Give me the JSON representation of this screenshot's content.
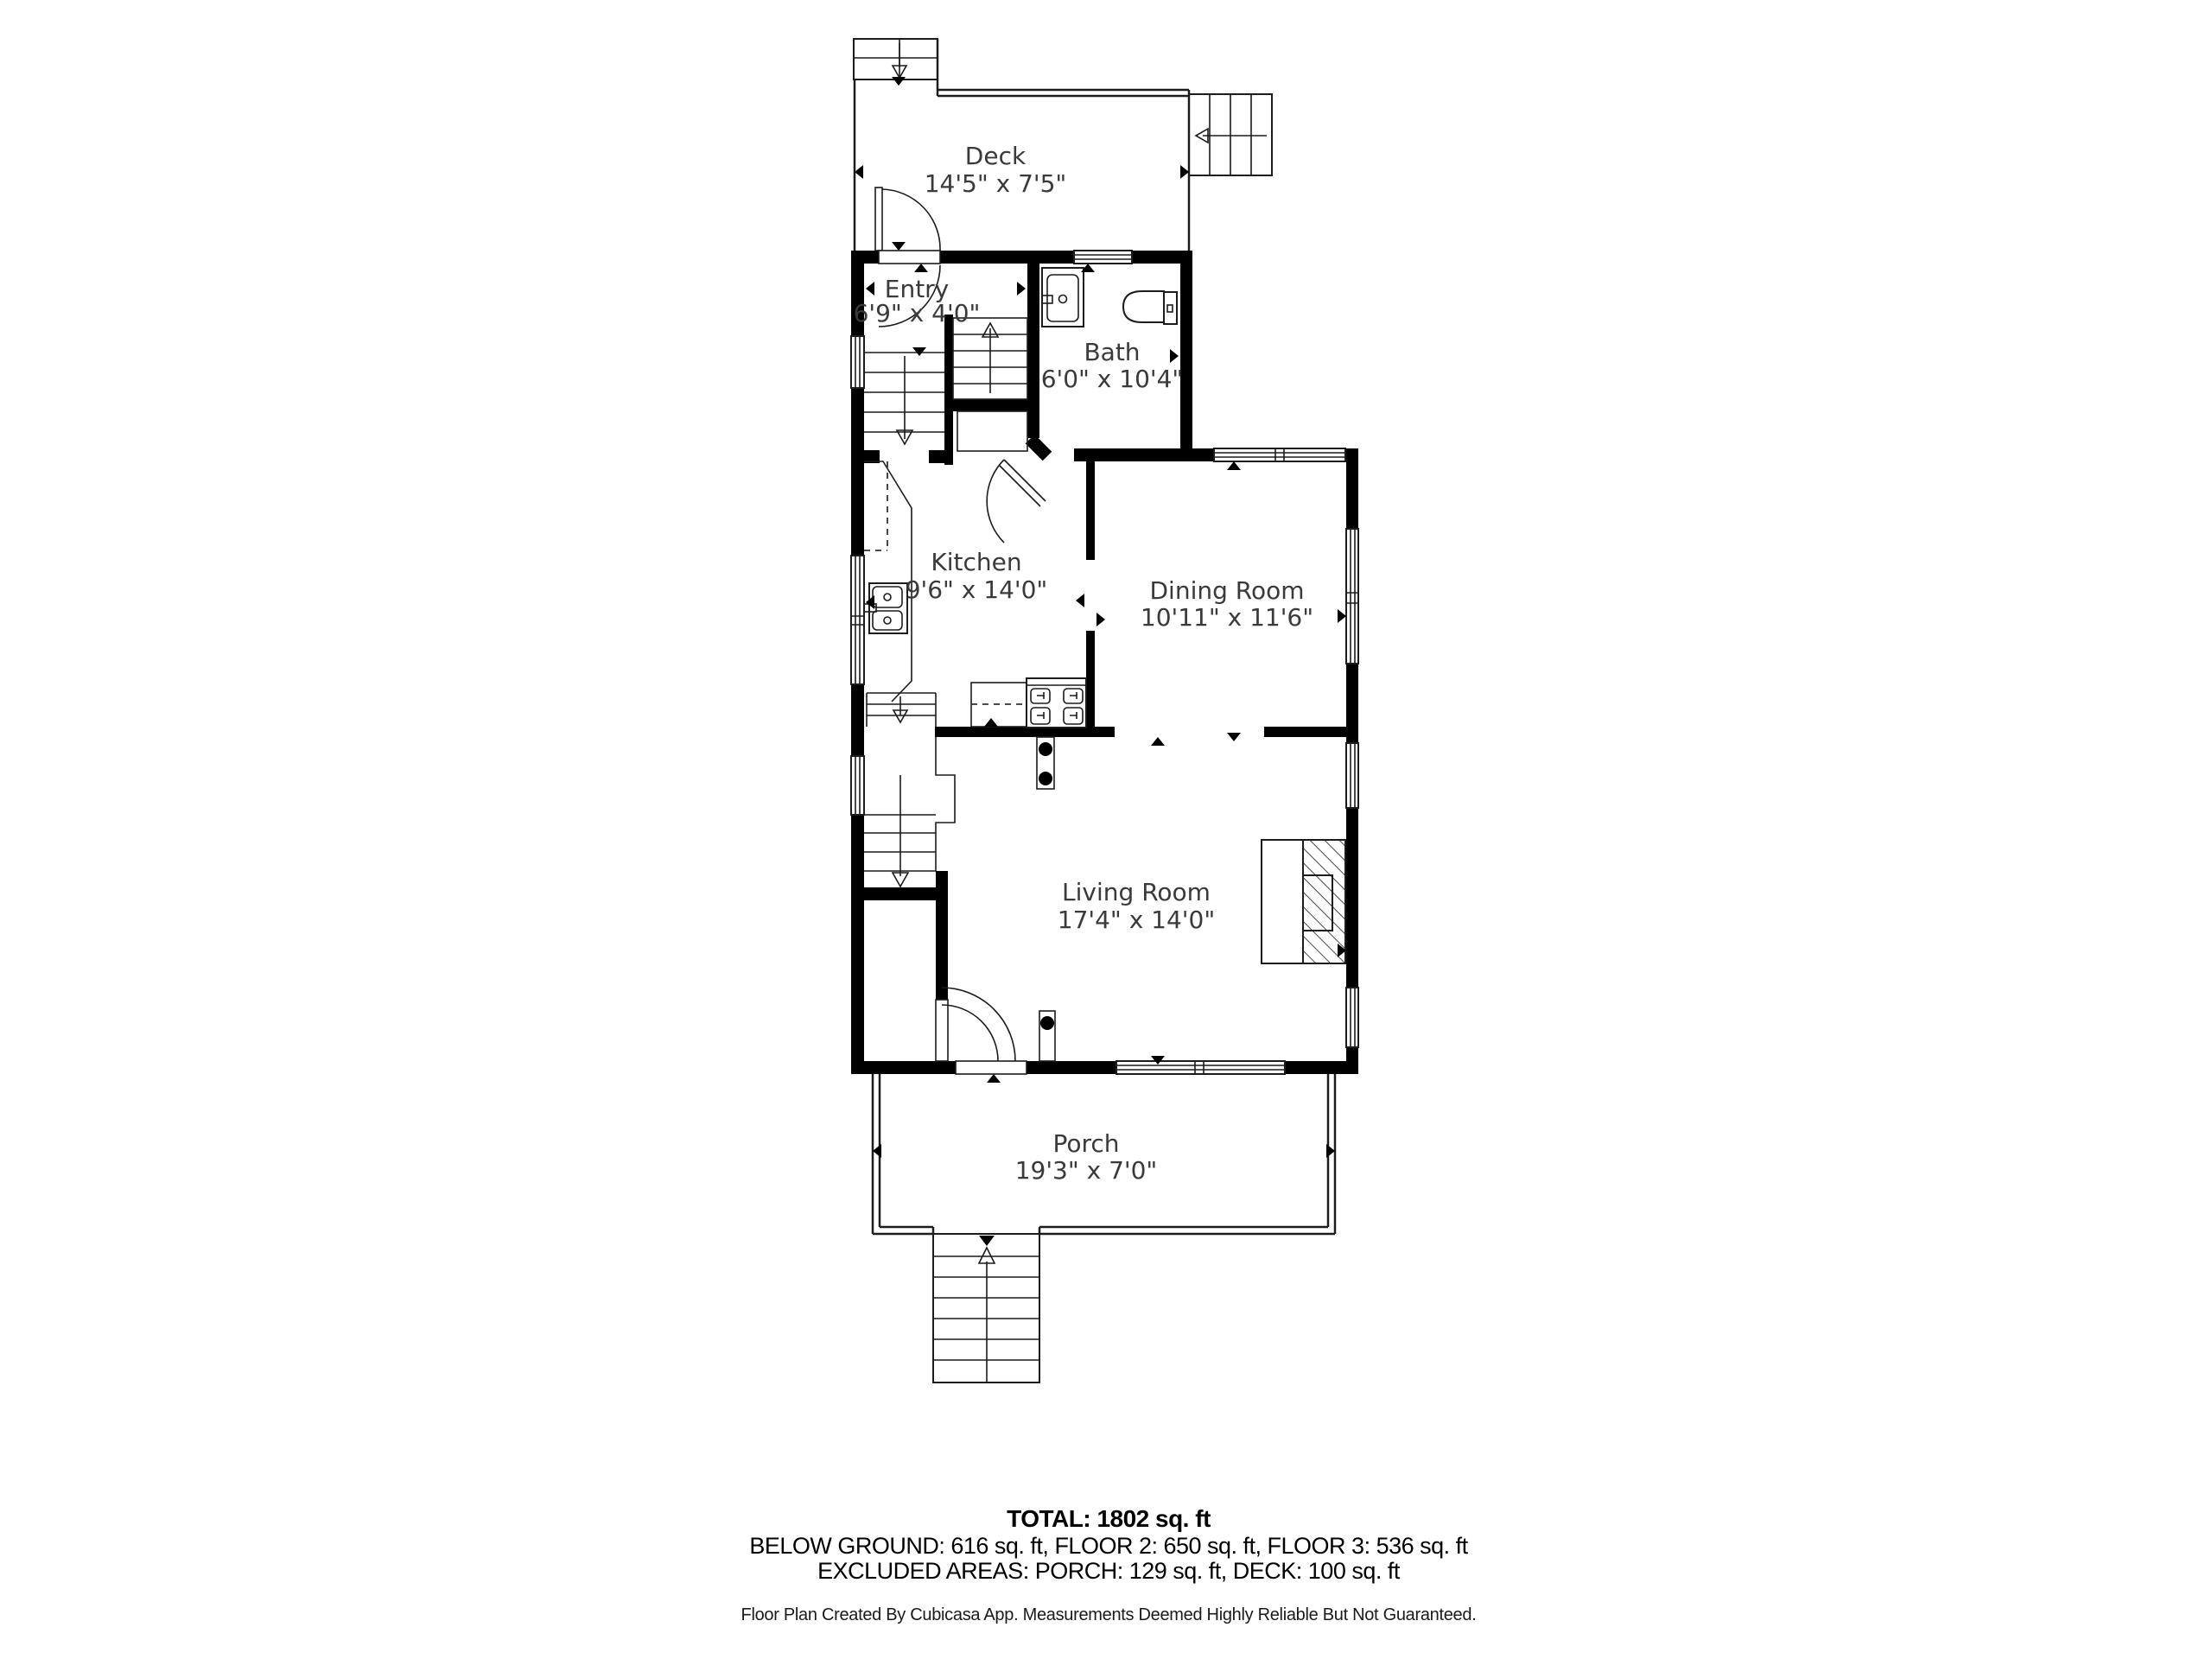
{
  "rooms": {
    "deck": {
      "name": "Deck",
      "dims": "14'5\" x 7'5\""
    },
    "entry": {
      "name": "Entry",
      "dims": "6'9\" x 4'0\""
    },
    "bath": {
      "name": "Bath",
      "dims": "6'0\" x 10'4\""
    },
    "kitchen": {
      "name": "Kitchen",
      "dims": "9'6\" x 14'0\""
    },
    "dining": {
      "name": "Dining Room",
      "dims": "10'11\" x 11'6\""
    },
    "living": {
      "name": "Living Room",
      "dims": "17'4\" x 14'0\""
    },
    "porch": {
      "name": "Porch",
      "dims": "19'3\" x 7'0\""
    }
  },
  "summary": {
    "total": "TOTAL: 1802 sq. ft",
    "floors": "BELOW GROUND: 616 sq. ft, FLOOR 2: 650 sq. ft, FLOOR 3: 536 sq. ft",
    "excluded": "EXCLUDED AREAS: PORCH: 129 sq. ft, DECK: 100 sq. ft"
  },
  "footer": "Floor Plan Created By Cubicasa App. Measurements Deemed Highly Reliable But Not Guaranteed.",
  "colors": {
    "wall": "#000000",
    "line": "#1c1c1c",
    "label": "#3a3a3a"
  }
}
